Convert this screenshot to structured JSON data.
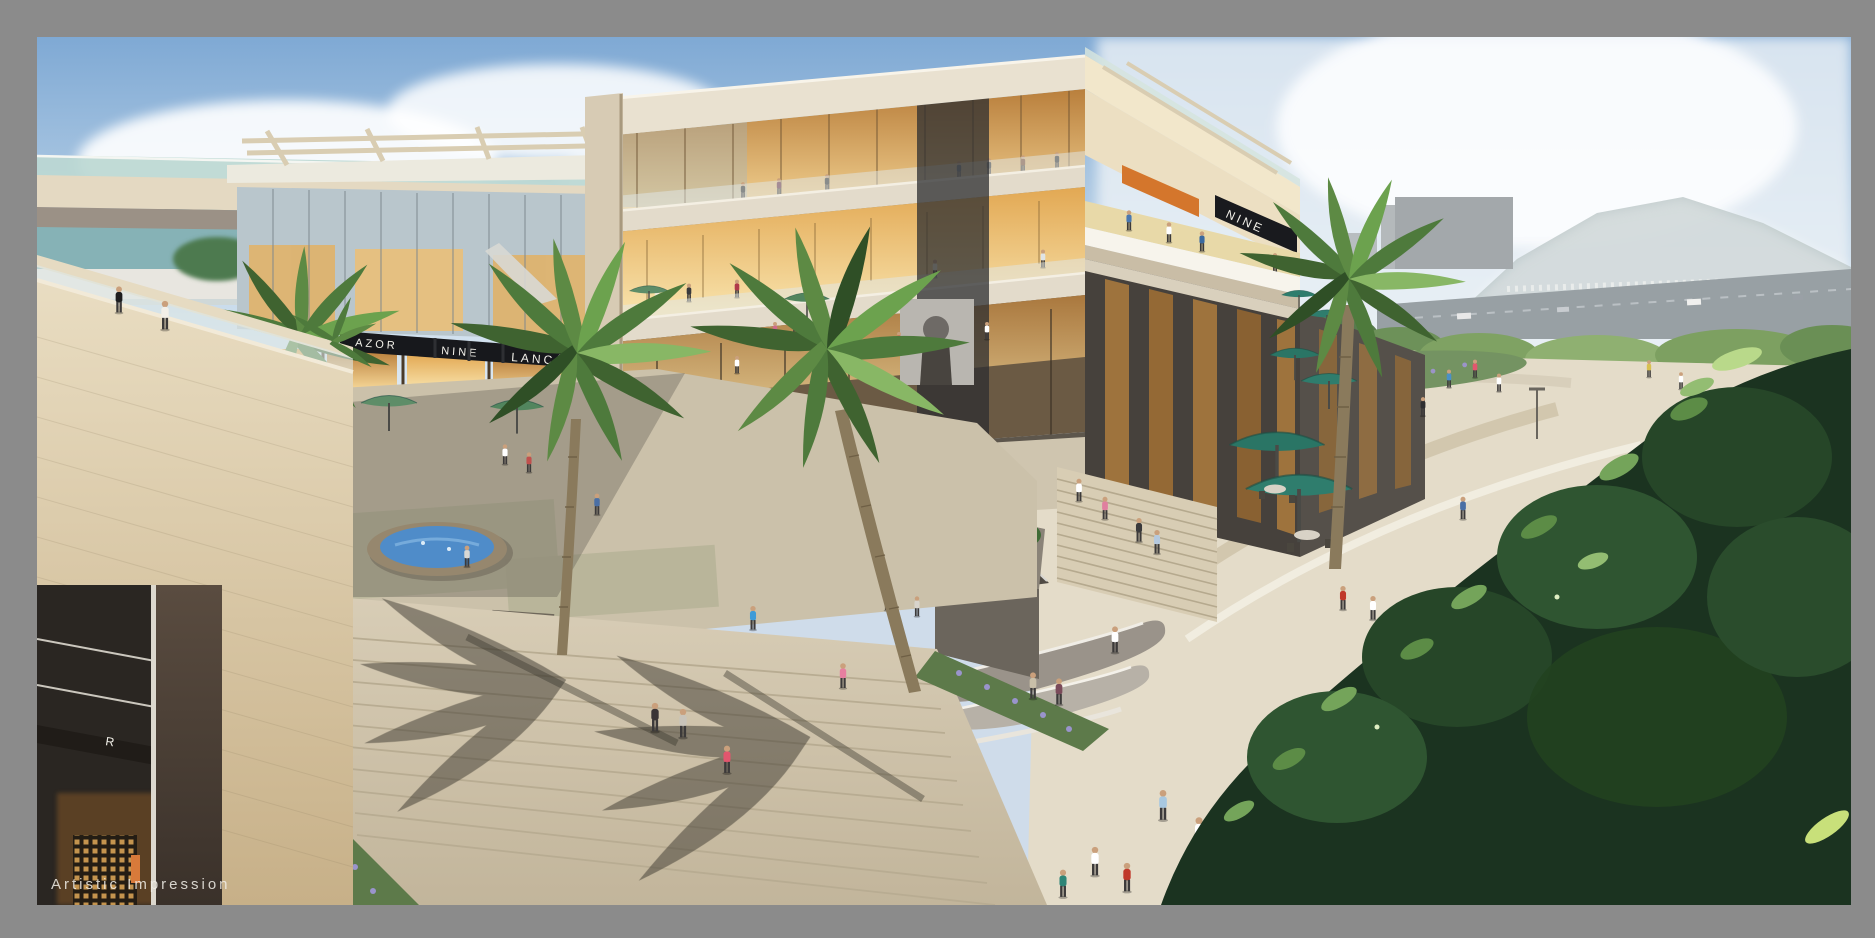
{
  "image": {
    "caption": "Artistic Impression",
    "description": "Aerial artist's impression of an open-air retail mall: multi-storey glass shopping galleria, plaza with palm trees, oval fountain, teal cafe umbrellas, grand steps and pedestrians, hazy hills behind",
    "frame_color": "#8b8b8b"
  },
  "signage": {
    "court_store_1": "AZOR",
    "court_store_2": "NINE",
    "court_store_3": "LANCÔME",
    "terrace_store": "NINE",
    "left_storefront_letter": "R"
  },
  "palette": {
    "sky_top": "#7fa9d4",
    "sky_horizon": "#edf2f5",
    "concrete": "#d6cab4",
    "travertine": "#dcc9a4",
    "warm_glass": "#e8a84f",
    "umbrella_teal": "#2f7d6d",
    "umbrella_sage": "#5e8d68",
    "foliage_dark": "#1b3320",
    "palm_green": "#558a3f",
    "water": "#4f8cc9",
    "lavender": "#938dc4",
    "pavement": "#e4dcc9"
  }
}
